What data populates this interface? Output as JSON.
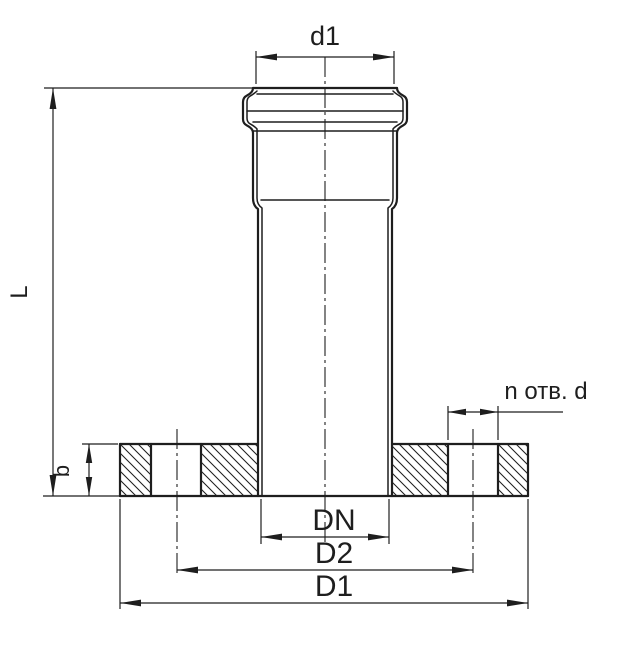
{
  "drawing": {
    "colors": {
      "ink": "#1e1e1e",
      "background": "#ffffff"
    },
    "dimensions": {
      "socket_outer_diameter": {
        "label": "d1"
      },
      "overall_length": {
        "label": "L"
      },
      "flange_thickness": {
        "label": "b"
      },
      "bolt_holes": {
        "label": "n отв. d"
      },
      "nominal_bore": {
        "label": "DN"
      },
      "bolt_circle_diameter": {
        "label": "D2"
      },
      "flange_outer_diameter": {
        "label": "D1"
      }
    }
  }
}
